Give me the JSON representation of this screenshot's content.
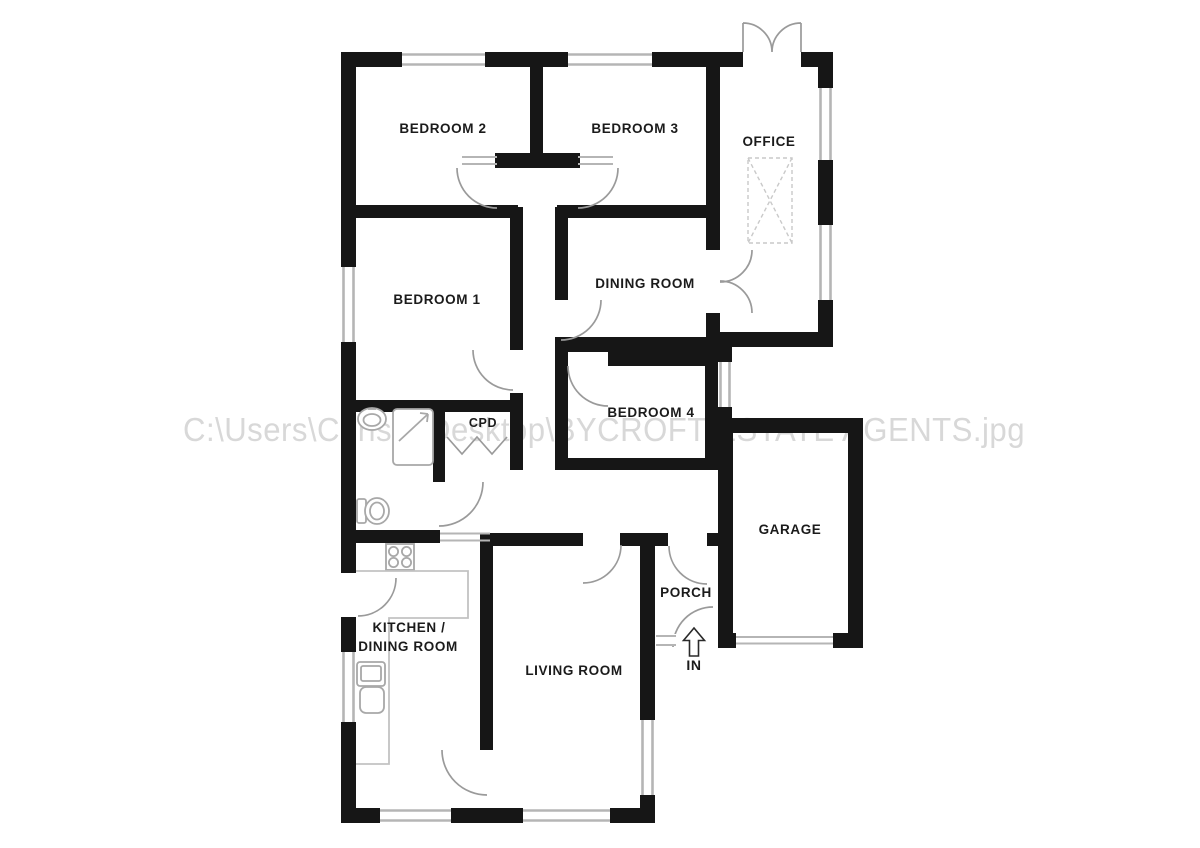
{
  "watermark": {
    "text": "C:\\Users\\Chris 3\\Desktop\\BYCROFT ESTATE AGENTS.jpg"
  },
  "rooms": {
    "bedroom2": "BEDROOM 2",
    "bedroom3": "BEDROOM 3",
    "office": "OFFICE",
    "bedroom1": "BEDROOM 1",
    "dining_room": "DINING ROOM",
    "bedroom4": "BEDROOM 4",
    "cpd": "CPD",
    "garage": "GARAGE",
    "kitchen_line1": "KITCHEN /",
    "kitchen_line2": "DINING ROOM",
    "living_room": "LIVING ROOM",
    "porch": "PORCH",
    "entrance": "IN"
  },
  "colors": {
    "wall": "#161616",
    "window_line": "#b5b5b5",
    "door_arc": "#9a9a9a",
    "fixture": "#a8a8a8",
    "counter": "#c2c2c2",
    "label": "#1b1b1b",
    "watermark": "#d8d8d8",
    "background": "#ffffff"
  }
}
